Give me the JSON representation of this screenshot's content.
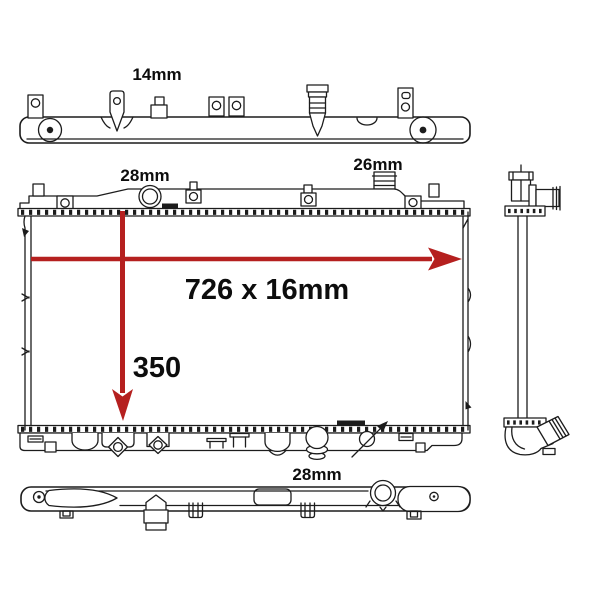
{
  "colors": {
    "background": "#ffffff",
    "line": "#1c1c1c",
    "label": "#0d0d0d",
    "dimension": "#b5201f"
  },
  "labels": {
    "top_view_fitting": "14mm",
    "front_top_tank": "28mm",
    "front_inlet": "26mm",
    "core_dimensions": "726 x 16mm",
    "core_height": "350",
    "bottom_view_tank": "28mm"
  }
}
